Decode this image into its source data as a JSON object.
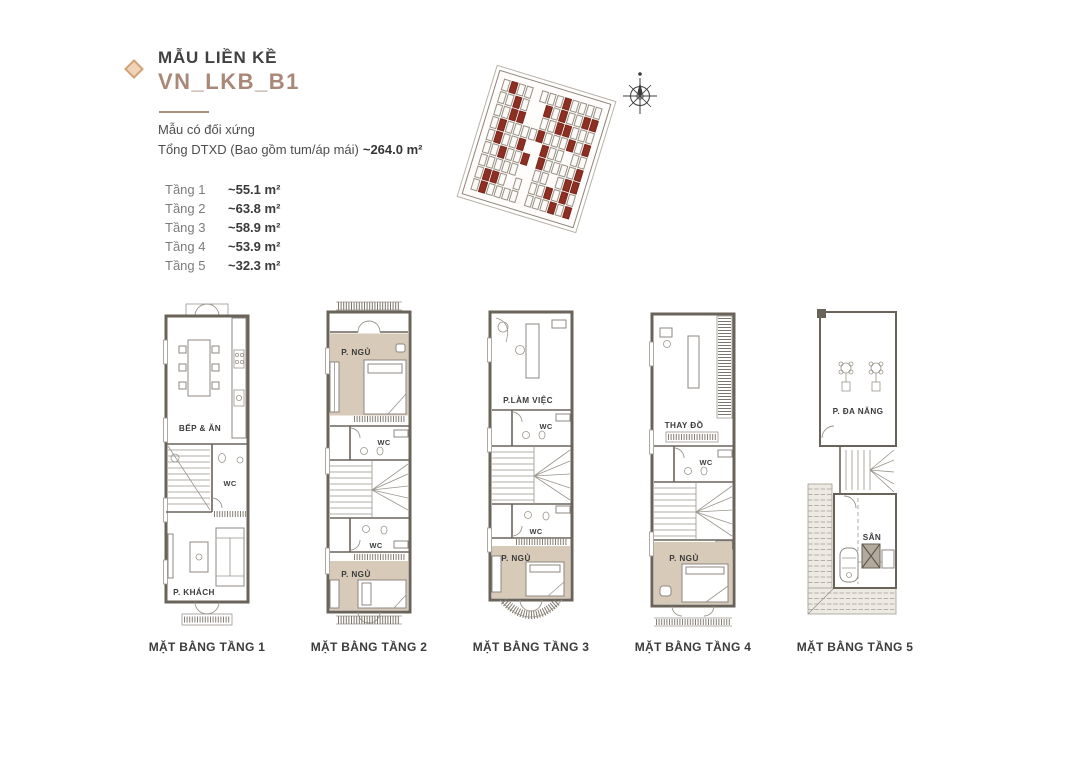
{
  "header": {
    "title": "MẪU LIỀN KỀ",
    "model": "VN_LKB_B1",
    "subtitle": "Mẫu có đối xứng",
    "total_label": "Tổng DTXD (Bao gồm tum/áp mái)",
    "total_area": "~264.0 m²"
  },
  "floors": [
    {
      "label": "Tầng 1",
      "area": "~55.1 m²"
    },
    {
      "label": "Tầng 2",
      "area": "~63.8 m²"
    },
    {
      "label": "Tầng 3",
      "area": "~58.9 m²"
    },
    {
      "label": "Tầng 4",
      "area": "~53.9 m²"
    },
    {
      "label": "Tầng 5",
      "area": "~32.3 m²"
    }
  ],
  "plans": [
    {
      "caption": "MẶT BẰNG TẦNG 1",
      "rooms": [
        "BẾP & ĂN",
        "WC",
        "P. KHÁCH"
      ]
    },
    {
      "caption": "MẶT BẰNG TẦNG 2",
      "rooms": [
        "P. NGỦ",
        "WC",
        "WC",
        "P. NGỦ"
      ]
    },
    {
      "caption": "MẶT BẰNG TẦNG 3",
      "rooms": [
        "P.LÀM VIỆC",
        "WC",
        "WC",
        "P. NGỦ"
      ]
    },
    {
      "caption": "MẶT BẰNG TẦNG 4",
      "rooms": [
        "THAY ĐỒ",
        "WC",
        "P. NGỦ"
      ]
    },
    {
      "caption": "MẶT BẰNG TẦNG 5",
      "rooms": [
        "P. ĐA NĂNG",
        "SÂN"
      ]
    }
  ],
  "site_plan": {
    "rows": 9,
    "cols": 13,
    "seed": 13,
    "holes": [
      17,
      18,
      30,
      31,
      57,
      58,
      71,
      84,
      97,
      110
    ],
    "lot_color": "#fbfaf8",
    "highlight_color": "#8e2f24",
    "outline_color": "#8d8579"
  },
  "colors": {
    "accent_brown": "#a98878",
    "diamond_tan": "#d2a176",
    "room_beige": "#d7cab9",
    "wall": "#6a635a",
    "lot_red": "#8e2f24"
  }
}
